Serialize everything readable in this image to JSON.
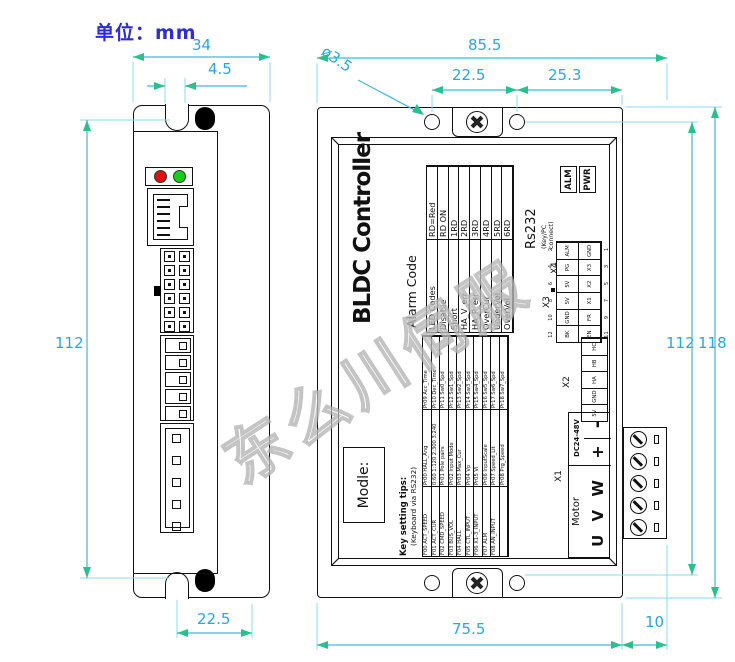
{
  "unit_label": "单位：mm",
  "watermark": "东么川伺服",
  "dims": {
    "side_width": "34",
    "side_slot": "4.5",
    "side_height": "112",
    "side_bottom": "22.5",
    "front_total_width": "85.5",
    "front_hole_dia": "ø3.5",
    "front_hole_left": "22.5",
    "front_hole_right": "25.3",
    "front_hole_height": "112",
    "front_total_height": "118",
    "front_body_width": "75.5",
    "front_terminal": "10"
  },
  "panel": {
    "model_label": "Modle:",
    "title": "BLDC Controller",
    "alarm": {
      "heading": "Alarm Code",
      "header": [
        "LED Codes",
        "RD=Red"
      ],
      "rows": [
        [
          "Disable",
          "RD ON"
        ],
        [
          "Short",
          "1RD"
        ],
        [
          "HA_V_err",
          "2RD"
        ],
        [
          "HA_P_err",
          "3RD"
        ],
        [
          "OverCur",
          "4RD"
        ],
        [
          "UnderVol",
          "5RD"
        ],
        [
          "OverVol",
          "6RD"
        ]
      ]
    },
    "keys": {
      "heading": "Key setting tips:",
      "subheading": "(Keyboard via RS232)",
      "rows": [
        [
          "F00 ACT_SPEED",
          "Pr00 HALL_Ang",
          "Pr09 Acc_Time"
        ],
        [
          "F01 ACT_CUR",
          "0:60 1:120 2:300 3:240",
          "Pr10 Dec_Time"
        ],
        [
          "F02 CMD_SPEED",
          "Pr01 Pole pairs",
          "Pr11 Sw0_Spd"
        ],
        [
          "F03 BUS_VOL",
          "Pr02 Input Mode",
          "Pr12 Sw1_Spd"
        ],
        [
          "F04 HALL",
          "Pr03 Max_Cur",
          "Pr13 Sw2_Spd"
        ],
        [
          "F05 CTL_INPUT",
          "Pr04 Vp",
          "Pr14 Sw3_Spd"
        ],
        [
          "F06 X1-3_INPUT",
          "Pr05 Vi",
          "Pr15 Sw4_Spd"
        ],
        [
          "F07 ALM",
          "Pr06 InputScale",
          "Pr16 Sw5_Spd"
        ],
        [
          "F08 AN_INPUT",
          "Pr07 Speed_Lit",
          "Pr17 Sw6_Spd"
        ],
        [
          "",
          "Pr08 Prg_Speed",
          "Pr18 Sw7_Spd"
        ]
      ]
    },
    "leds": {
      "alm": "ALM",
      "pwr": "PWR"
    },
    "x4": {
      "label": "X4",
      "title": "Rs232",
      "subtitle": "(Key/PC connect)"
    },
    "x3": {
      "label": "X3",
      "pins_top": [
        "12",
        "10",
        "8",
        "6",
        "4",
        "2"
      ],
      "row1": [
        "BK",
        "GND",
        "5V",
        "5V",
        "PG",
        "ALM"
      ],
      "row2": [
        "EN",
        "FR",
        "X1",
        "X2",
        "X3",
        "GND"
      ],
      "pins_bottom": [
        "11",
        "9",
        "7",
        "5",
        "3",
        "1"
      ]
    },
    "x2": {
      "label": "X2",
      "cells": [
        "5V",
        "GND",
        "HA",
        "HB",
        "HC"
      ]
    },
    "x1": {
      "label": "X1",
      "motor_label": "Motor",
      "power_label": "DC24-48V",
      "motor_pins": "U V W",
      "power_plus": "+",
      "power_minus": "-"
    }
  },
  "colors": {
    "dim_line": "#3fb3e6",
    "dim_arrow": "#29c08d",
    "dim_text": "#2aa6e0",
    "unit_text": "#2d2ed0",
    "led_red": "#e01010",
    "led_green": "#17cf17"
  }
}
